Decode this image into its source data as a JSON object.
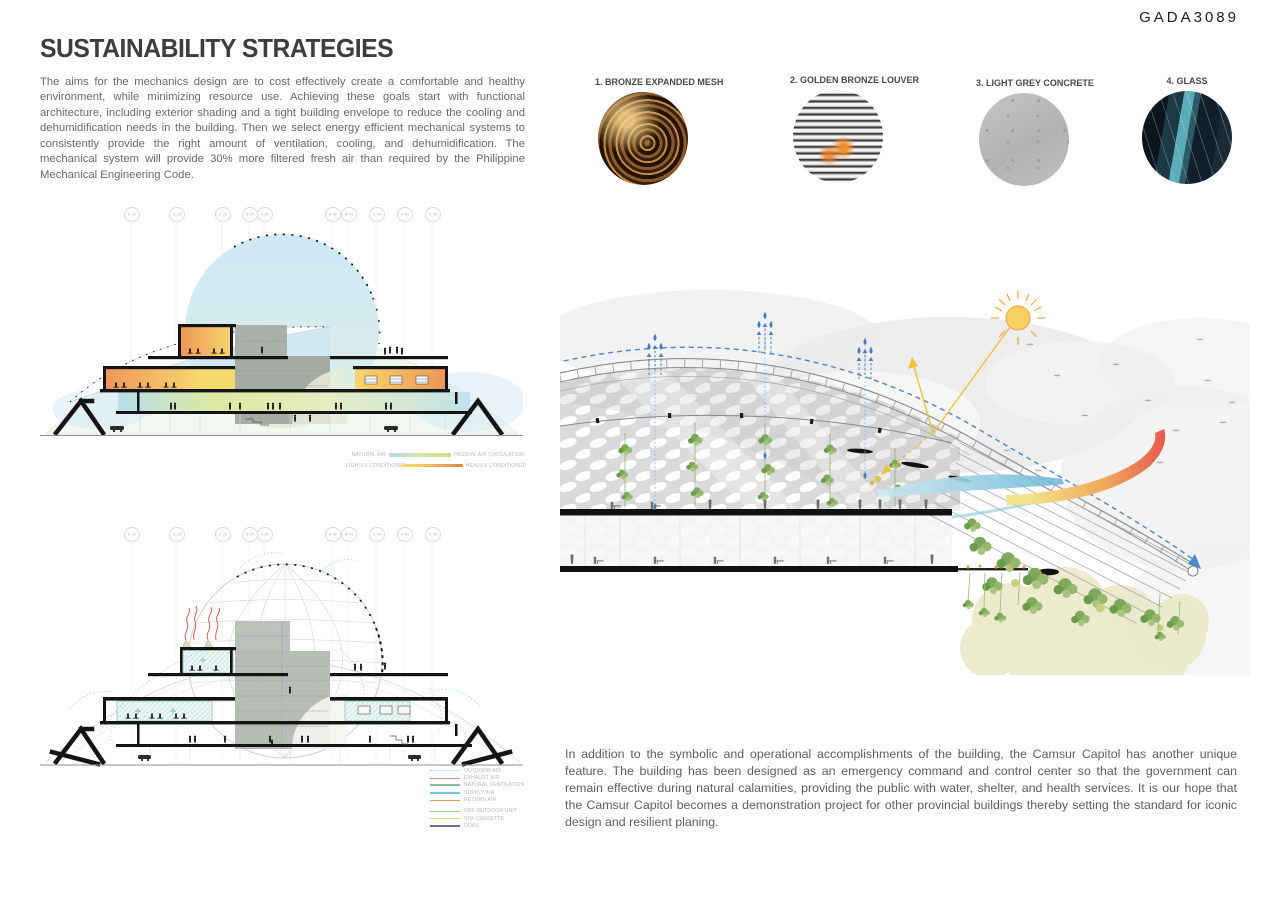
{
  "page": {
    "code": "GADA3089",
    "background": "#ffffff"
  },
  "header": {
    "title": "SUSTAINABILITY STRATEGIES"
  },
  "intro": {
    "text": "The aims for the mechanics design are to cost effectively create a comfortable and healthy environment, while minimizing resource use. Achieving these goals start with functional architecture, including exterior shading and a tight building envelope to reduce the cooling and dehumidification needs in the building. Then we select energy efficient mechanical systems to consistently provide the right amount of ventilation, cooling, and dehumidification. The mechanical system will provide 30% more filtered fresh air than required by the Philippine Mechanical Engineering Code."
  },
  "outro": {
    "text": "In addition to the symbolic and operational accomplishments of the building, the Camsur Capitol has another unique feature. The building has been designed as an emergency command and control center so that the government can remain effective during natural calamities, providing the public with water, shelter, and health services. It is our hope that the Camsur Capitol becomes a demonstration project for other provincial buildings thereby setting the standard for iconic design and resilient planing."
  },
  "materials": [
    {
      "label": "1. BRONZE EXPANDED MESH"
    },
    {
      "label": "2. GOLDEN BRONZE LOUVER"
    },
    {
      "label": "3. LIGHT GREY CONCRETE"
    },
    {
      "label": "4. GLASS"
    }
  ],
  "grid_labels": [
    "E-25",
    "D-25",
    "C-25",
    "B-25",
    "A-25",
    "A-09",
    "B-09",
    "C-09",
    "D-09",
    "E-09"
  ],
  "section_top": {
    "legend": [
      {
        "left": "NATURAL AIR",
        "right": "PASSIVE AIR CIRCULATION",
        "gradient": "linear-gradient(90deg,#b5dce9 0%,#cfe6b2 45%,#cbde7e 100%)"
      },
      {
        "left": "LIGHTLY CONDITIONED",
        "right": "HEAVILY CONDITIONED",
        "gradient": "linear-gradient(90deg,#f5df6b 0%,#f0b25c 55%,#e5834a 100%)"
      }
    ]
  },
  "section_bottom": {
    "legend": [
      {
        "label": "OUTDOOR AIR",
        "color": "#a9d5e8",
        "style": "dotted"
      },
      {
        "label": "EXHAUST AIR",
        "color": "#d98f8f",
        "style": "solid"
      },
      {
        "label": "NATURAL VENTILATION",
        "color": "#84c0a4",
        "style": "solid"
      },
      {
        "label": "SUPPLY AIR",
        "color": "#6fc3de",
        "style": "solid"
      },
      {
        "label": "RETURN AIR",
        "color": "#e89a5a",
        "style": "solid"
      },
      {
        "label": "VRF OUTDOOR UNIT",
        "color": "#9fce8e",
        "style": "solid"
      },
      {
        "label": "VRF CASSETTE",
        "color": "#e3da7d",
        "style": "solid"
      },
      {
        "label": "DOAS",
        "color": "#5d6f9e",
        "style": "solid"
      }
    ]
  },
  "colors": {
    "dome_blue": "#cfe9f6",
    "thermal_yellow_green": "#dfe79a",
    "thermal_orange": "#f09a58",
    "core_grey": "#a6aca4",
    "sun_yellow": "#f6cd5a",
    "airflow_blue": "#4a86c8",
    "warm_air_red": "#e85a50",
    "cool_air_blue": "#6cb8da",
    "vegetation_green": "#7fa85a",
    "exhaust_red": "#d55f5f",
    "conditioned_teal": "#8fc8c0"
  }
}
